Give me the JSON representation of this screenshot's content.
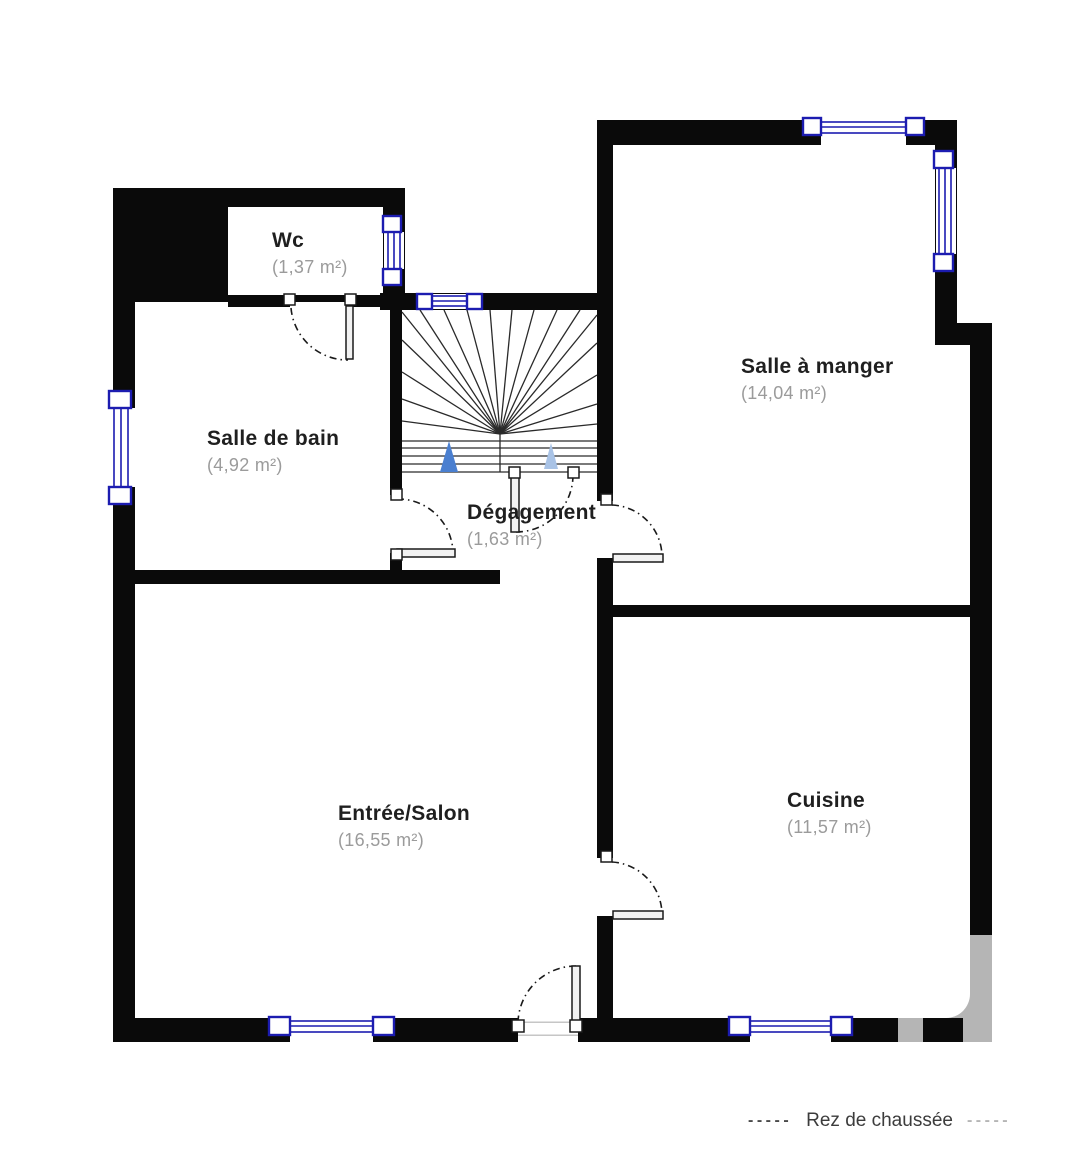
{
  "rooms": [
    {
      "id": "wc",
      "name": "Wc",
      "area": "(1,37 m²)"
    },
    {
      "id": "salle-de-bain",
      "name": "Salle de bain",
      "area": "(4,92 m²)"
    },
    {
      "id": "salle-a-manger",
      "name": "Salle à manger",
      "area": "(14,04 m²)"
    },
    {
      "id": "degagement",
      "name": "Dégagement",
      "area": "(1,63 m²)"
    },
    {
      "id": "entree-salon",
      "name": "Entrée/Salon",
      "area": "(16,55 m²)"
    },
    {
      "id": "cuisine",
      "name": "Cuisine",
      "area": "(11,57 m²)"
    }
  ],
  "legend": {
    "left_dashes": "-----",
    "label": "Rez de chaussée",
    "right_dashes": "-----"
  },
  "colors": {
    "wall": "#0a0a0a",
    "window_blue": "#1c1cb0",
    "room_name": "#1f1f1f",
    "room_area": "#9b9b9b",
    "stair_arrow_primary": "#4a7fd0",
    "stair_arrow_secondary": "#a9c3e6",
    "watermark_gray": "#b5b5b5"
  }
}
